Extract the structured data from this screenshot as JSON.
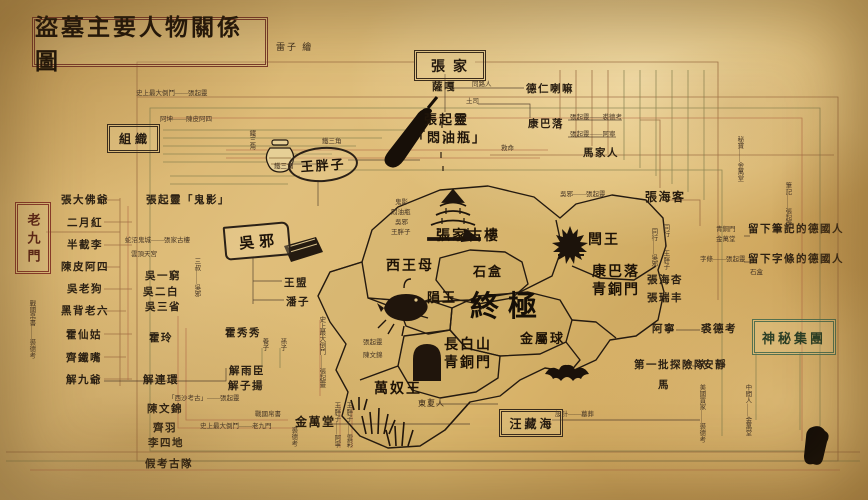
{
  "title": "盜墓主要人物關係圖",
  "credit": "雷子 繪",
  "group_boxes": {
    "zhangjia": "張家",
    "zuzhi": "組織",
    "laojiumen": "老九門",
    "shenmi_jituan": "神秘集團",
    "wangzanghai": "汪藏海"
  },
  "trio": {
    "wuxie": "吳邪",
    "wangpangzi": "王胖子"
  },
  "colors": {
    "paper": "#dcb873",
    "ink": "#241a10",
    "red_frame": "#8a3b2a",
    "green_frame": "#55714f",
    "line_brown": "#96663e",
    "line_olive": "#7d7b4b",
    "line_red": "#b06746"
  },
  "icons": [
    "sword-icon",
    "jar-icon",
    "book-icon",
    "pagoda-icon",
    "crest-icon",
    "fish-icon",
    "cave-icon",
    "claw-icon",
    "bat-icon",
    "seal-stamp"
  ],
  "labels": [
    {
      "t": "史上最大倒鬥——張起靈",
      "x": 136,
      "y": 91,
      "c": "t"
    },
    {
      "t": "阿坤——陳皮阿四",
      "x": 160,
      "y": 117,
      "c": "t"
    },
    {
      "t": "鐵三角",
      "x": 322,
      "y": 139,
      "c": "t"
    },
    {
      "t": "鐵三角",
      "x": 274,
      "y": 164,
      "c": "t"
    },
    {
      "t": "鐵三角",
      "x": 247,
      "y": 130,
      "c": "t",
      "v": 1
    },
    {
      "t": "張起靈",
      "x": 424,
      "y": 113,
      "c": "n3"
    },
    {
      "t": "「悶油瓶」",
      "x": 412,
      "y": 131,
      "c": "n3"
    },
    {
      "t": "薩嘎",
      "x": 432,
      "y": 82,
      "c": "n"
    },
    {
      "t": "同路人",
      "x": 472,
      "y": 82,
      "c": "t"
    },
    {
      "t": "土司",
      "x": 466,
      "y": 99,
      "c": "t"
    },
    {
      "t": "德仁喇嘛",
      "x": 526,
      "y": 84,
      "c": "n"
    },
    {
      "t": "康巴落",
      "x": 528,
      "y": 119,
      "c": "n"
    },
    {
      "t": "張起靈——裘德考",
      "x": 570,
      "y": 115,
      "c": "t"
    },
    {
      "t": "張起靈——阿寧",
      "x": 570,
      "y": 132,
      "c": "t"
    },
    {
      "t": "馬家人",
      "x": 583,
      "y": 148,
      "c": "n"
    },
    {
      "t": "救命",
      "x": 501,
      "y": 146,
      "c": "t"
    },
    {
      "t": "吳邪——張起靈",
      "x": 560,
      "y": 192,
      "c": "t"
    },
    {
      "t": "張海客",
      "x": 645,
      "y": 191,
      "c": "n2"
    },
    {
      "t": "同行——吳邪",
      "x": 649,
      "y": 228,
      "c": "t",
      "v": 1
    },
    {
      "t": "同行——王胖子",
      "x": 661,
      "y": 224,
      "c": "t",
      "v": 1
    },
    {
      "t": "秘寶——金萬堂",
      "x": 735,
      "y": 136,
      "c": "t",
      "v": 1
    },
    {
      "t": "筆記——張起靈",
      "x": 783,
      "y": 182,
      "c": "t",
      "v": 1
    },
    {
      "t": "留下筆記的德國人",
      "x": 748,
      "y": 224,
      "c": "n"
    },
    {
      "t": "青銅門",
      "x": 716,
      "y": 227,
      "c": "t"
    },
    {
      "t": "金萬堂",
      "x": 716,
      "y": 237,
      "c": "t"
    },
    {
      "t": "字條——張起靈",
      "x": 700,
      "y": 257,
      "c": "t"
    },
    {
      "t": "留下字條的德國人",
      "x": 748,
      "y": 254,
      "c": "n"
    },
    {
      "t": "石盒",
      "x": 750,
      "y": 270,
      "c": "t"
    },
    {
      "t": "張海杏",
      "x": 647,
      "y": 275,
      "c": "n"
    },
    {
      "t": "張瑞丰",
      "x": 647,
      "y": 293,
      "c": "n"
    },
    {
      "t": "阿寧",
      "x": 652,
      "y": 324,
      "c": "n"
    },
    {
      "t": "裘德考",
      "x": 701,
      "y": 324,
      "c": "n"
    },
    {
      "t": "第一批探險隊",
      "x": 634,
      "y": 360,
      "c": "n"
    },
    {
      "t": "安靜",
      "x": 703,
      "y": 360,
      "c": "n"
    },
    {
      "t": "馬",
      "x": 658,
      "y": 380,
      "c": "n"
    },
    {
      "t": "美國買家——裘德考",
      "x": 697,
      "y": 384,
      "c": "t",
      "v": 1
    },
    {
      "t": "中間人——金萬堂",
      "x": 743,
      "y": 384,
      "c": "t",
      "v": 1
    },
    {
      "t": "張大佛爺",
      "x": 61,
      "y": 195,
      "c": "n"
    },
    {
      "t": "二月紅",
      "x": 67,
      "y": 218,
      "c": "n"
    },
    {
      "t": "半截李",
      "x": 67,
      "y": 240,
      "c": "n"
    },
    {
      "t": "陳皮阿四",
      "x": 61,
      "y": 262,
      "c": "n"
    },
    {
      "t": "吳老狗",
      "x": 67,
      "y": 284,
      "c": "n"
    },
    {
      "t": "黑背老六",
      "x": 61,
      "y": 306,
      "c": "n"
    },
    {
      "t": "霍仙姑",
      "x": 66,
      "y": 330,
      "c": "n"
    },
    {
      "t": "齊鐵嘴",
      "x": 66,
      "y": 353,
      "c": "n"
    },
    {
      "t": "解九爺",
      "x": 66,
      "y": 375,
      "c": "n"
    },
    {
      "t": "戰國帛書——裘德考",
      "x": 27,
      "y": 300,
      "c": "t",
      "v": 1
    },
    {
      "t": "張起靈「鬼影」",
      "x": 146,
      "y": 195,
      "c": "n"
    },
    {
      "t": "蛇沼鬼城——張家古樓",
      "x": 125,
      "y": 238,
      "c": "t"
    },
    {
      "t": "雲頂天宮",
      "x": 131,
      "y": 252,
      "c": "t"
    },
    {
      "t": "吳一窮",
      "x": 145,
      "y": 271,
      "c": "n"
    },
    {
      "t": "吳二白",
      "x": 143,
      "y": 287,
      "c": "n"
    },
    {
      "t": "吳三省",
      "x": 145,
      "y": 302,
      "c": "n"
    },
    {
      "t": "三叔——吳邪",
      "x": 192,
      "y": 258,
      "c": "t",
      "v": 1
    },
    {
      "t": "霍玲",
      "x": 149,
      "y": 333,
      "c": "n"
    },
    {
      "t": "解連環",
      "x": 143,
      "y": 375,
      "c": "n"
    },
    {
      "t": "陳文錦",
      "x": 147,
      "y": 404,
      "c": "n"
    },
    {
      "t": "齊羽",
      "x": 153,
      "y": 423,
      "c": "n"
    },
    {
      "t": "李四地",
      "x": 148,
      "y": 438,
      "c": "n"
    },
    {
      "t": "假考古隊",
      "x": 145,
      "y": 459,
      "c": "n"
    },
    {
      "t": "王盟",
      "x": 284,
      "y": 278,
      "c": "n"
    },
    {
      "t": "潘子",
      "x": 286,
      "y": 297,
      "c": "n"
    },
    {
      "t": "霍秀秀",
      "x": 225,
      "y": 328,
      "c": "n"
    },
    {
      "t": "養子",
      "x": 260,
      "y": 338,
      "c": "t",
      "v": 1
    },
    {
      "t": "孫子",
      "x": 278,
      "y": 338,
      "c": "t",
      "v": 1
    },
    {
      "t": "解雨臣",
      "x": 229,
      "y": 366,
      "c": "n"
    },
    {
      "t": "解子揚",
      "x": 228,
      "y": 381,
      "c": "n"
    },
    {
      "t": "「西沙考古」——張起靈",
      "x": 168,
      "y": 396,
      "c": "t"
    },
    {
      "t": "戰國帛書",
      "x": 255,
      "y": 412,
      "c": "t"
    },
    {
      "t": "史上最大倒鬥——老九門",
      "x": 200,
      "y": 424,
      "c": "t"
    },
    {
      "t": "金萬堂",
      "x": 295,
      "y": 416,
      "c": "n2"
    },
    {
      "t": "裘德考",
      "x": 289,
      "y": 427,
      "c": "t",
      "v": 1
    },
    {
      "t": "王胖子——阿寧",
      "x": 332,
      "y": 402,
      "c": "t",
      "v": 1
    },
    {
      "t": "王胖子——雲彩",
      "x": 344,
      "y": 402,
      "c": "t",
      "v": 1
    },
    {
      "t": "史上最大倒鬥——張起靈",
      "x": 317,
      "y": 316,
      "c": "t",
      "v": 1
    },
    {
      "t": "鬼影",
      "x": 395,
      "y": 200,
      "c": "t"
    },
    {
      "t": "悶油瓶",
      "x": 391,
      "y": 210,
      "c": "t"
    },
    {
      "t": "吳邪",
      "x": 395,
      "y": 220,
      "c": "t"
    },
    {
      "t": "王胖子",
      "x": 391,
      "y": 230,
      "c": "t"
    },
    {
      "t": "張起靈",
      "x": 363,
      "y": 340,
      "c": "t"
    },
    {
      "t": "陳文錦",
      "x": 363,
      "y": 353,
      "c": "t"
    },
    {
      "t": "張家古樓",
      "x": 436,
      "y": 230,
      "c": "m1"
    },
    {
      "t": "西王母",
      "x": 386,
      "y": 260,
      "c": "m1"
    },
    {
      "t": "石盒",
      "x": 473,
      "y": 265,
      "c": "m3"
    },
    {
      "t": "隕玉",
      "x": 427,
      "y": 291,
      "c": "m3"
    },
    {
      "t": "終極",
      "x": 470,
      "y": 292,
      "c": "m2"
    },
    {
      "t": "閆王",
      "x": 588,
      "y": 234,
      "c": "m1"
    },
    {
      "t": "康巴落",
      "x": 592,
      "y": 266,
      "c": "m1"
    },
    {
      "t": "青銅門",
      "x": 592,
      "y": 284,
      "c": "m1"
    },
    {
      "t": "金屬球",
      "x": 520,
      "y": 332,
      "c": "m3"
    },
    {
      "t": "長白山",
      "x": 444,
      "y": 339,
      "c": "m1"
    },
    {
      "t": "青銅門",
      "x": 444,
      "y": 357,
      "c": "m1"
    },
    {
      "t": "萬奴王",
      "x": 374,
      "y": 383,
      "c": "m1"
    },
    {
      "t": "東夏人",
      "x": 418,
      "y": 400,
      "c": "t2"
    },
    {
      "t": "設計——墓葬",
      "x": 555,
      "y": 412,
      "c": "t"
    }
  ]
}
